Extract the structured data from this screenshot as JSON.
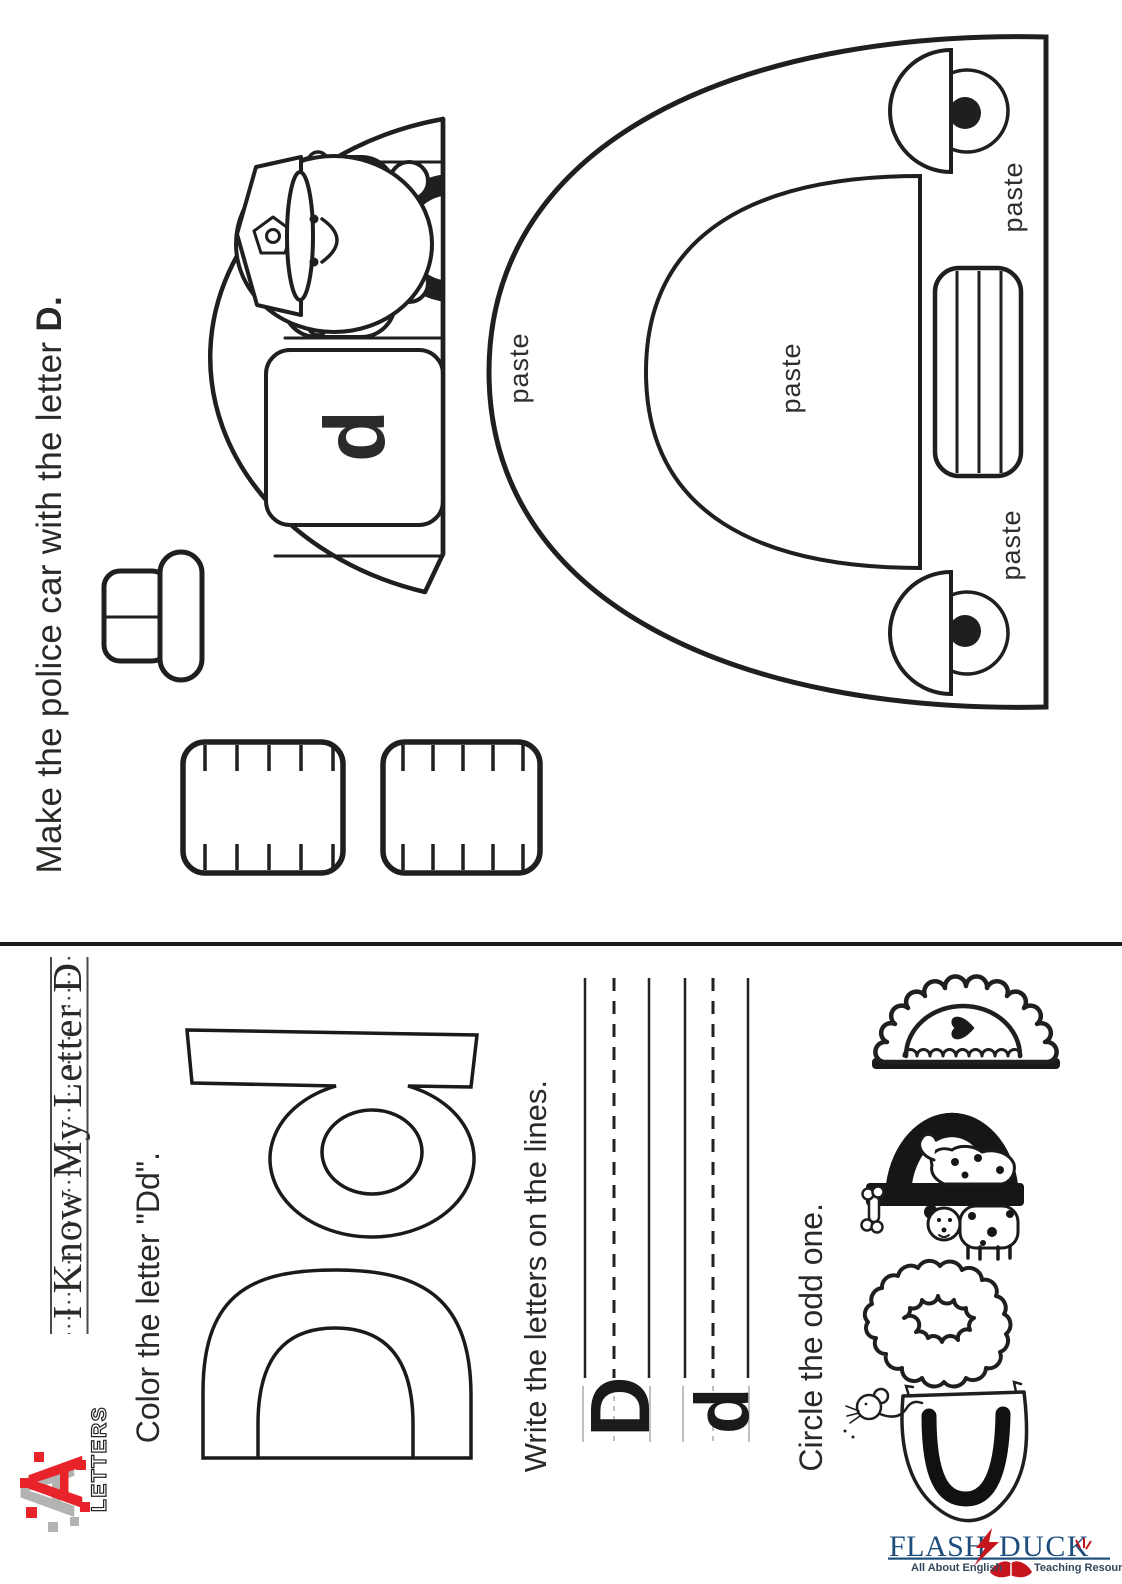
{
  "colors": {
    "ink": "#231f20",
    "brand_blue": "#1d4d7c",
    "brand_red": "#c5161d",
    "logo_red": "#e8242a",
    "logo_gray": "#b3b3b3"
  },
  "top_sheet": {
    "title_regular": "Make the police car with the letter ",
    "title_bold": "D.",
    "door_letter": "d",
    "paste": "paste"
  },
  "bottom_sheet": {
    "heading": "I Know My Letter D",
    "aletters_logo": {
      "letter_a": "A",
      "word": "LETTERS"
    },
    "color_section": {
      "instruction": "Color the letter \"Dd\".",
      "display_letters": "Dd"
    },
    "write_section": {
      "instruction": "Write the letters on the lines.",
      "sample_upper": "D",
      "sample_lower": "d"
    },
    "circle_section": {
      "instruction": "Circle the odd one.",
      "items": [
        "C with mouse",
        "fluffy D",
        "D with dalmatian",
        "frilly D with heart"
      ]
    },
    "footer": {
      "word1": "FLASH",
      "word2": "DUCK",
      "tagline_left": "All About English",
      "tagline_right": "Teaching Resources"
    }
  }
}
